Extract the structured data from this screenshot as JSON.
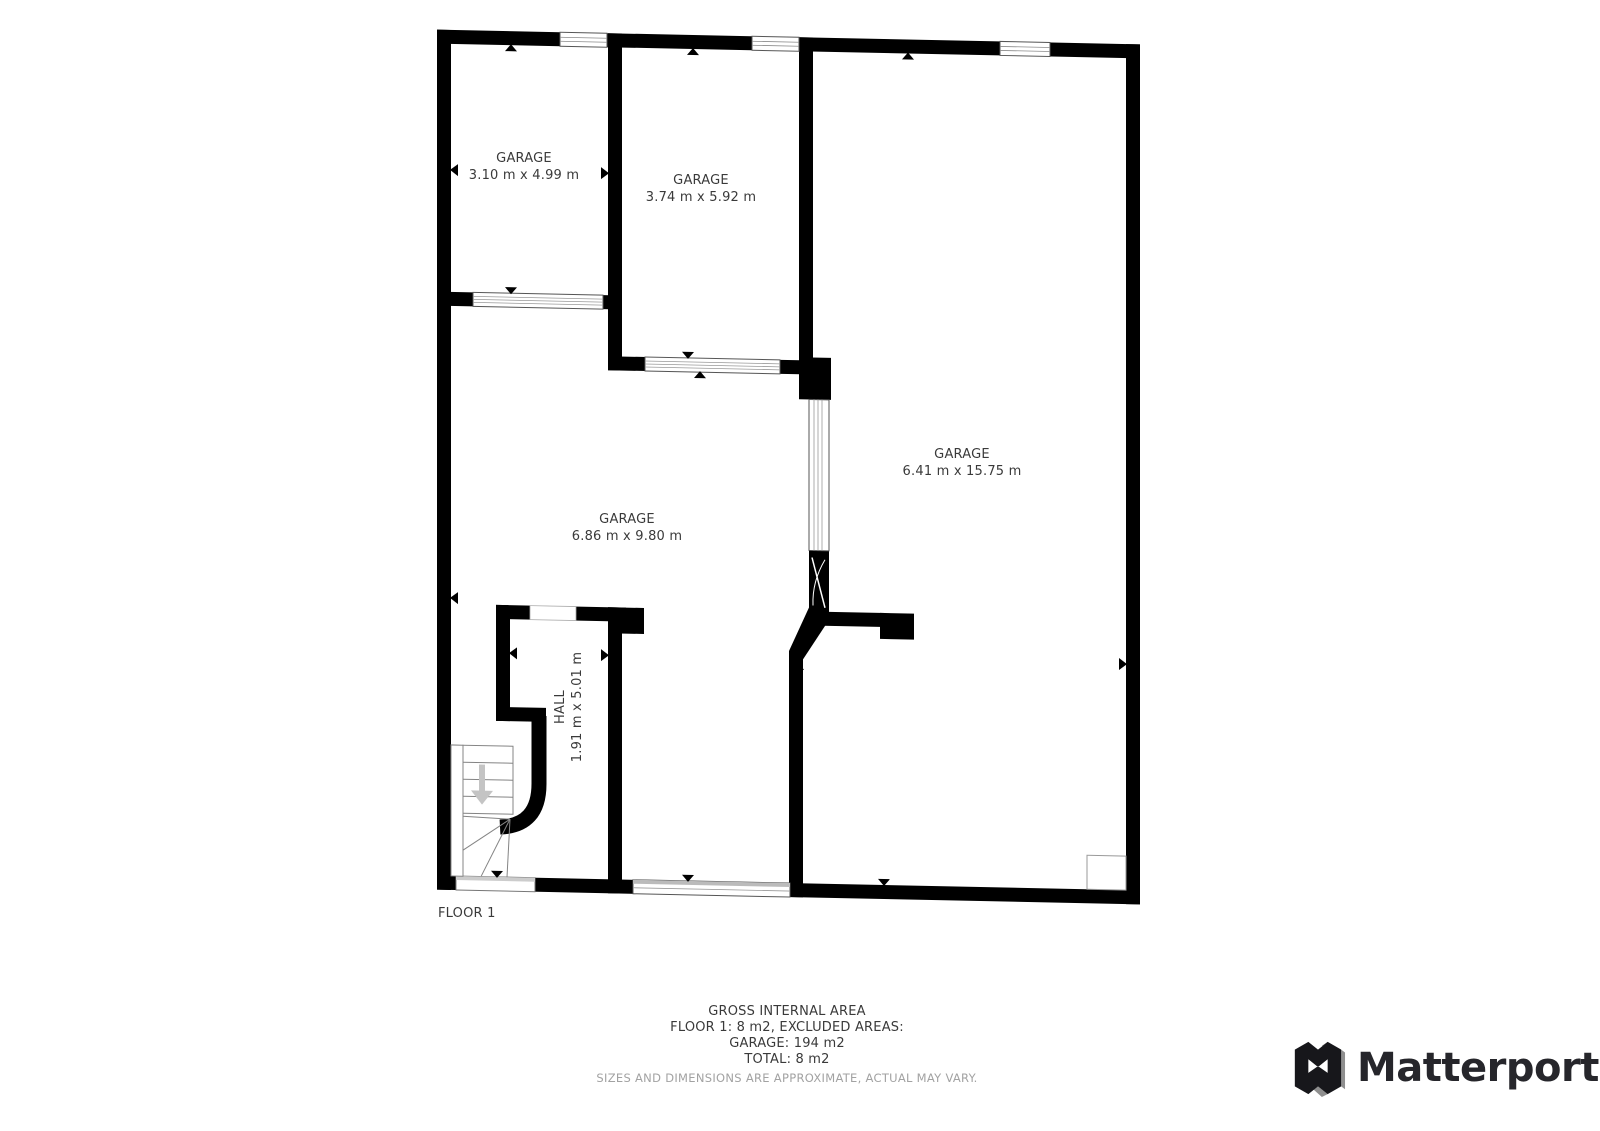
{
  "rooms": [
    {
      "id": "garage-1",
      "name": "GARAGE",
      "dims": "3.10 m x 4.99 m"
    },
    {
      "id": "garage-2",
      "name": "GARAGE",
      "dims": "3.74 m x 5.92 m"
    },
    {
      "id": "garage-right",
      "name": "GARAGE",
      "dims": "6.41 m x 15.75 m"
    },
    {
      "id": "garage-main",
      "name": "GARAGE",
      "dims": "6.86 m x 9.80 m"
    },
    {
      "id": "hall",
      "name": "HALL",
      "dims": "1.91 m x 5.01 m"
    }
  ],
  "floor_label": "FLOOR 1",
  "summary": {
    "title": "GROSS INTERNAL AREA",
    "line1": "FLOOR 1: 8 m2, EXCLUDED AREAS:",
    "line2": "GARAGE: 194 m2",
    "line3": "TOTAL: 8 m2",
    "disclaimer": "SIZES AND DIMENSIONS ARE APPROXIMATE, ACTUAL MAY VARY."
  },
  "branding": {
    "logo_text": "Matterport"
  },
  "colors": {
    "wall": "#000000",
    "label": "#3a3a3a",
    "fine_print": "#a2a2a2",
    "logo": "#26262b"
  }
}
